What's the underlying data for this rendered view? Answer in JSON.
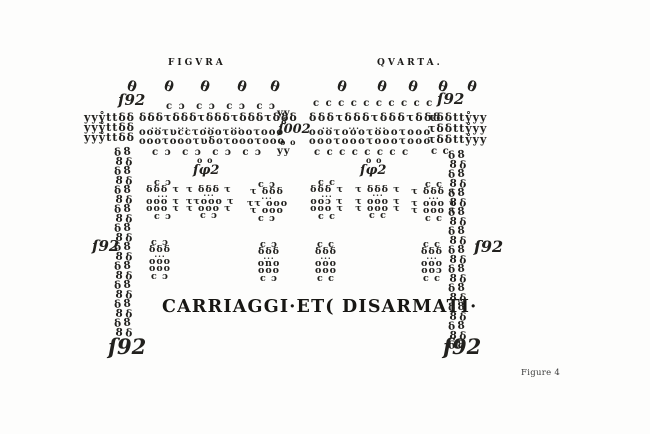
{
  "meta": {
    "background": "#fdfdfc",
    "ink": "#22211e"
  },
  "labels": {
    "figura": "FIGVRA",
    "quarta": "QVARTA.",
    "banner": "CARRIAGGI·ET( DISARMATI·",
    "caption": "Figure 4"
  },
  "figure": {
    "ovals": {
      "glyph": "θ",
      "y": 80,
      "fs": 14,
      "xs": [
        127,
        164,
        200,
        237,
        270,
        337,
        377,
        408,
        438,
        467
      ]
    },
    "numbers": [
      {
        "name": "count-top-left",
        "t": "ſ92",
        "x": 118,
        "y": 93,
        "fs": 15
      },
      {
        "name": "count-top-right",
        "t": "ſ92",
        "x": 437,
        "y": 92,
        "fs": 15
      },
      {
        "name": "count-band-center",
        "t": "ſ002",
        "x": 278,
        "y": 123,
        "fs": 13
      },
      {
        "name": "count-upper-mid-left",
        "t": "ſφ2",
        "x": 193,
        "y": 164,
        "fs": 13
      },
      {
        "name": "count-upper-mid-right",
        "t": "ſφ2",
        "x": 360,
        "y": 164,
        "fs": 13
      },
      {
        "name": "count-mid-left",
        "t": "ſ92",
        "x": 92,
        "y": 239,
        "fs": 15
      },
      {
        "name": "count-mid-right",
        "t": "ſ92",
        "x": 474,
        "y": 239,
        "fs": 16
      },
      {
        "name": "count-bottom-left",
        "t": "ſ92",
        "x": 108,
        "y": 336,
        "fs": 21,
        "w": 700
      },
      {
        "name": "count-bottom-right",
        "t": "ſ92",
        "x": 443,
        "y": 336,
        "fs": 21,
        "w": 700
      }
    ],
    "band_rows": [
      {
        "name": "band-c-row-left-top",
        "t": "c ɔ  c ɔ  c ɔ  c ɔ",
        "x": 166,
        "y": 102,
        "fs": 10,
        "ls": 1.5,
        "crow": true
      },
      {
        "name": "band-row-left-flags",
        "t": "δδδτδδδτδδδτδδδτδδδ",
        "x": 139,
        "y": 112,
        "fs": 11
      },
      {
        "name": "band-row-left-dots",
        "t": "···    ···    ···    ···",
        "x": 151,
        "y": 124,
        "fs": 8,
        "crow": true
      },
      {
        "name": "band-row-left-circles-1",
        "t": "οοοτυccτοοοτοοοτοοο",
        "x": 139,
        "y": 128,
        "fs": 10
      },
      {
        "name": "band-row-left-circles-2",
        "t": "οοοτοοοτυδοτοοοτοοο",
        "x": 139,
        "y": 137,
        "fs": 10
      },
      {
        "name": "band-c-row-left-bottom",
        "t": "c ɔ  c ɔ  c ɔ  c ɔ",
        "x": 152,
        "y": 148,
        "fs": 10,
        "ls": 1.5,
        "crow": true
      },
      {
        "name": "band-c-row-right-top",
        "t": "c c c c c c c c c c",
        "x": 313,
        "y": 99,
        "fs": 10,
        "ls": 1.5,
        "crow": true
      },
      {
        "name": "band-row-right-flags",
        "t": "δδδτδδδτδδδτδδδ",
        "x": 309,
        "y": 112,
        "fs": 11,
        "ls": 1.5
      },
      {
        "name": "band-row-right-dots",
        "t": "···    ···    ···",
        "x": 322,
        "y": 124,
        "fs": 8,
        "crow": true
      },
      {
        "name": "band-row-right-circles-1",
        "t": "οοοτοοοτοοοτοοο",
        "x": 309,
        "y": 128,
        "fs": 10,
        "ls": 1.5
      },
      {
        "name": "band-row-right-circles-2",
        "t": "οοοτοοοτοοοτοοο",
        "x": 309,
        "y": 137,
        "fs": 10,
        "ls": 1.5
      },
      {
        "name": "band-c-row-right-bottom",
        "t": "c c c c c c c c",
        "x": 314,
        "y": 148,
        "fs": 10,
        "ls": 1.5,
        "crow": true
      }
    ],
    "edge_rows": [
      {
        "name": "left-edge-cluster-1",
        "t": "yyẙttδδ",
        "x": 84,
        "y": 112,
        "fs": 11,
        "crow": true
      },
      {
        "name": "left-edge-cluster-2",
        "t": "yyẙttδδ",
        "x": 84,
        "y": 122,
        "fs": 11,
        "crow": true
      },
      {
        "name": "left-edge-cluster-3",
        "t": "yyẙttδδ",
        "x": 84,
        "y": 132,
        "fs": 11,
        "crow": true
      },
      {
        "name": "right-edge-cluster-1",
        "t": "τδδttẙyy",
        "x": 428,
        "y": 112,
        "fs": 11,
        "crow": true
      },
      {
        "name": "right-edge-cluster-2",
        "t": "τδδttẙyy",
        "x": 428,
        "y": 123,
        "fs": 11,
        "crow": true
      },
      {
        "name": "right-edge-cluster-3",
        "t": "τδδttẙyy",
        "x": 428,
        "y": 134,
        "fs": 11,
        "crow": true
      },
      {
        "name": "right-edge-c-pair",
        "t": "c c",
        "x": 431,
        "y": 147,
        "fs": 10,
        "crow": true
      }
    ],
    "center_cluster": [
      {
        "name": "center-yy-top",
        "t": "yy",
        "x": 277,
        "y": 109,
        "fs": 10,
        "crow": true
      },
      {
        "name": "center-eight",
        "t": "8",
        "x": 281,
        "y": 117,
        "fs": 8
      },
      {
        "name": "center-oo",
        "t": "o o",
        "x": 280,
        "y": 138,
        "fs": 8
      },
      {
        "name": "center-yy-bottom",
        "t": "yy",
        "x": 277,
        "y": 147,
        "fs": 10,
        "crow": true
      }
    ],
    "headers": [
      {
        "name": "block-header-oo-left",
        "t": "o o",
        "x": 197,
        "y": 156,
        "fs": 8
      },
      {
        "name": "block-header-oo-right",
        "t": "o o",
        "x": 366,
        "y": 156,
        "fs": 8
      }
    ],
    "chains": [
      {
        "name": "left-chain-column",
        "x": 114,
        "y": 147,
        "rows": 20,
        "lh": 9.5,
        "fs": 10.5,
        "glyphs": [
          "δ8",
          "8δ"
        ]
      },
      {
        "name": "right-chain-column",
        "x": 448,
        "y": 150,
        "rows": 21,
        "lh": 9.5,
        "fs": 10.5,
        "glyphs": [
          "δ8",
          "8δ"
        ]
      }
    ],
    "blocks": [
      {
        "name": "upper-block-1",
        "x": 144,
        "y": 179,
        "w": 38,
        "lines": [
          "c ɔ",
          "δδδ τ",
          "···",
          "οοο τ",
          "οοο τ",
          "c ɔ"
        ]
      },
      {
        "name": "upper-block-2",
        "x": 186,
        "y": 186,
        "w": 46,
        "lines": [
          "τ δδδ τ",
          "···",
          "ττοοο τ",
          "τ οοο τ",
          "c ɔ"
        ]
      },
      {
        "name": "upper-block-3",
        "x": 247,
        "y": 181,
        "w": 40,
        "lines": [
          "c ɔ",
          "τ δδδ",
          "···",
          "ττ οοο",
          "τ οοο",
          "c ɔ"
        ]
      },
      {
        "name": "upper-block-4",
        "x": 309,
        "y": 179,
        "w": 36,
        "lines": [
          "c c",
          "δδδ τ",
          "···",
          "οοɔ τ",
          "οοο τ",
          "c c"
        ]
      },
      {
        "name": "upper-block-5",
        "x": 354,
        "y": 186,
        "w": 48,
        "lines": [
          "τ δδδ τ",
          "···",
          "τ οοο τ",
          "τ οοο τ",
          "c c"
        ]
      },
      {
        "name": "upper-block-6",
        "x": 411,
        "y": 181,
        "w": 46,
        "lines": [
          "c c",
          "τ δδδ τ",
          "···",
          "τ οοο τ",
          "τ οοο τ",
          "c c"
        ]
      },
      {
        "name": "lower-block-1",
        "x": 143,
        "y": 239,
        "w": 34,
        "lines": [
          "c ɔ",
          "δδδ",
          "···",
          "οοο",
          "οοο",
          "c ɔ"
        ]
      },
      {
        "name": "lower-block-2",
        "x": 252,
        "y": 241,
        "w": 34,
        "lines": [
          "c ɔ",
          "δδδ",
          "···",
          "οnο",
          "οοο",
          "c ɔ"
        ]
      },
      {
        "name": "lower-block-3",
        "x": 310,
        "y": 241,
        "w": 32,
        "lines": [
          "c c",
          "δδδ",
          "···",
          "οοο",
          "οοο",
          "c c"
        ]
      },
      {
        "name": "lower-block-4",
        "x": 415,
        "y": 241,
        "w": 34,
        "lines": [
          "c c",
          "δδδ",
          "···",
          "οοο",
          "οοɔ",
          "c c"
        ]
      }
    ]
  }
}
